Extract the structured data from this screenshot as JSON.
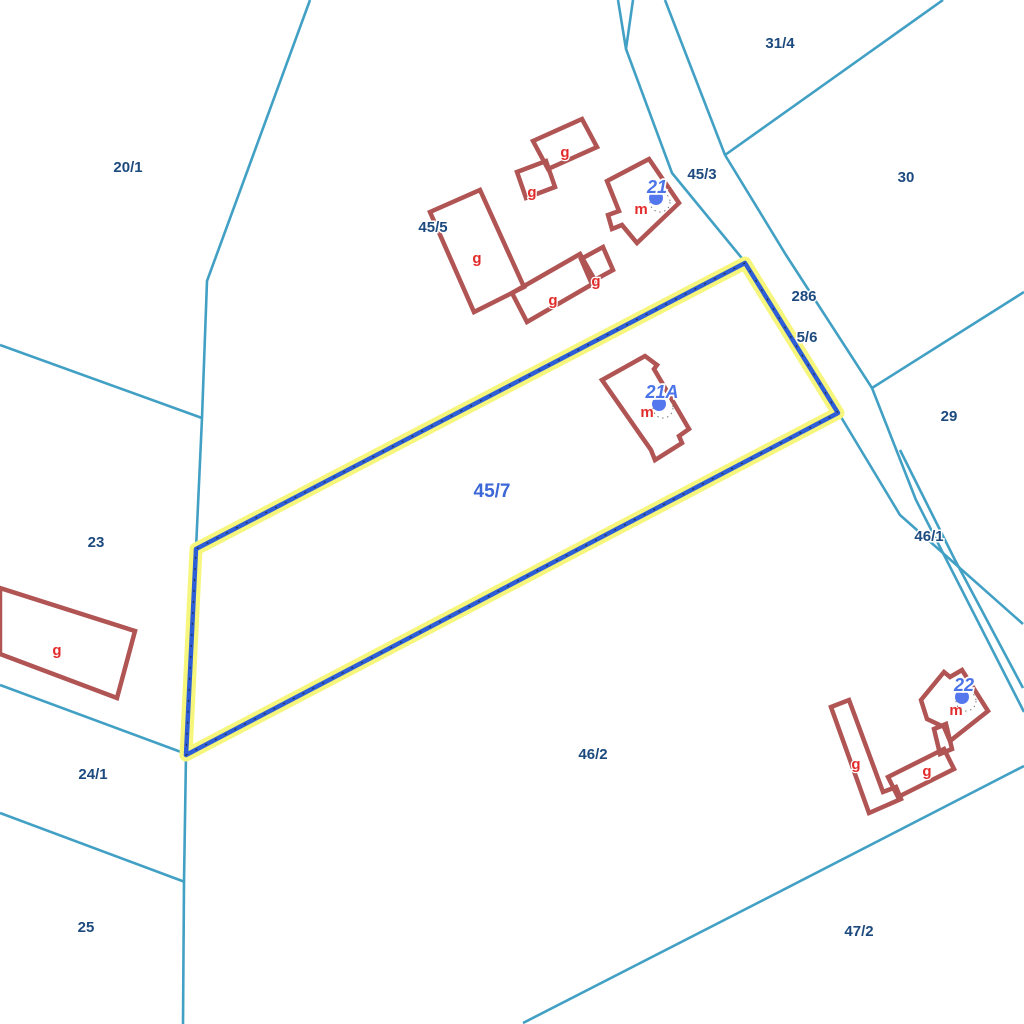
{
  "app": {
    "title": "cadastral-parcel-map"
  },
  "colors": {
    "background": "#ffffff",
    "boundary_teal": "#41a0c4",
    "parcel_label_navy": "#1d4a7e",
    "selected_parcel_blue": "#3c67d6",
    "highlight_halo_yellow": "#f6f67d",
    "highlight_core_blue": "#2d5dd7",
    "highlight_tick_dark": "#222222",
    "building_outline_red": "#b05454",
    "building_label_red": "#e22b2b",
    "address_number_blue": "#4b74e8",
    "address_dot_blue": "#5577ee",
    "label_halo_white": "#ffffff"
  },
  "map": {
    "width": 1024,
    "height": 1024,
    "selected_parcel": {
      "id": "45/7"
    },
    "highlight": {
      "name": "selected-parcel-45-7",
      "points": [
        [
          745,
          263
        ],
        [
          196,
          549
        ],
        [
          186,
          755
        ],
        [
          838,
          413
        ]
      ]
    },
    "boundaries": [
      {
        "name": "boundary-west-long",
        "points": [
          [
            310,
            0
          ],
          [
            207,
            281
          ],
          [
            202,
            418
          ],
          [
            196,
            549
          ],
          [
            186,
            755
          ],
          [
            184,
            882
          ],
          [
            183,
            1024
          ]
        ]
      },
      {
        "name": "boundary-20-1-23",
        "points": [
          [
            0,
            345
          ],
          [
            202,
            418
          ]
        ]
      },
      {
        "name": "boundary-23-24-1",
        "points": [
          [
            0,
            685
          ],
          [
            181,
            752
          ]
        ]
      },
      {
        "name": "boundary-24-1-25",
        "points": [
          [
            0,
            813
          ],
          [
            185,
            882
          ]
        ]
      },
      {
        "name": "road-west-edge-upper",
        "points": [
          [
            618,
            0
          ],
          [
            626,
            49
          ],
          [
            672,
            173
          ],
          [
            745,
            262
          ]
        ]
      },
      {
        "name": "road-fork-top",
        "points": [
          [
            633,
            0
          ],
          [
            626,
            49
          ]
        ]
      },
      {
        "name": "road-east-edge-top",
        "points": [
          [
            665,
            0
          ],
          [
            725,
            155
          ]
        ]
      },
      {
        "name": "boundary-31-4-30",
        "points": [
          [
            725,
            155
          ],
          [
            943,
            0
          ]
        ]
      },
      {
        "name": "road-east-edge-mid",
        "points": [
          [
            725,
            155
          ],
          [
            786,
            255
          ],
          [
            872,
            388
          ]
        ]
      },
      {
        "name": "boundary-30-29",
        "points": [
          [
            872,
            388
          ],
          [
            1024,
            292
          ]
        ]
      },
      {
        "name": "road-west-edge-lower",
        "points": [
          [
            838,
            412
          ],
          [
            900,
            515
          ],
          [
            1023,
            624
          ]
        ]
      },
      {
        "name": "road-east-edge-lower",
        "points": [
          [
            872,
            388
          ],
          [
            916,
            500
          ],
          [
            1024,
            712
          ]
        ]
      },
      {
        "name": "road-strip-46-1",
        "points": [
          [
            900,
            450
          ],
          [
            955,
            560
          ],
          [
            1023,
            688
          ]
        ]
      },
      {
        "name": "boundary-46-2-47-2",
        "points": [
          [
            523,
            1023
          ],
          [
            779,
            892
          ],
          [
            1024,
            766
          ]
        ]
      }
    ],
    "parcel_labels": [
      {
        "text": "20/1",
        "x": 128,
        "y": 172
      },
      {
        "text": "31/4",
        "x": 780,
        "y": 48
      },
      {
        "text": "30",
        "x": 906,
        "y": 182
      },
      {
        "text": "45/3",
        "x": 702,
        "y": 179
      },
      {
        "text": "45/5",
        "x": 433,
        "y": 232
      },
      {
        "text": "286",
        "x": 804,
        "y": 301
      },
      {
        "text": "5/6",
        "x": 807,
        "y": 342
      },
      {
        "text": "29",
        "x": 949,
        "y": 421
      },
      {
        "text": "46/1",
        "x": 929,
        "y": 541
      },
      {
        "text": "23",
        "x": 96,
        "y": 547
      },
      {
        "text": "24/1",
        "x": 93,
        "y": 779
      },
      {
        "text": "25",
        "x": 86,
        "y": 932
      },
      {
        "text": "46/2",
        "x": 593,
        "y": 759
      },
      {
        "text": "47/2",
        "x": 859,
        "y": 936
      }
    ],
    "selected_parcel_label": {
      "text": "45/7",
      "x": 492,
      "y": 497
    },
    "buildings": [
      {
        "name": "building-outbuilding-top",
        "points": [
          [
            533,
            141
          ],
          [
            582,
            119
          ],
          [
            597,
            147
          ],
          [
            548,
            169
          ]
        ]
      },
      {
        "name": "building-shed-small-top",
        "points": [
          [
            517,
            172
          ],
          [
            546,
            161
          ],
          [
            555,
            187
          ],
          [
            526,
            198
          ]
        ]
      },
      {
        "name": "building-barn-45-5",
        "points": [
          [
            430,
            212
          ],
          [
            480,
            190
          ],
          [
            524,
            287
          ],
          [
            474,
            312
          ]
        ]
      },
      {
        "name": "building-long-shed-45-5",
        "points": [
          [
            512,
            293
          ],
          [
            580,
            254
          ],
          [
            596,
            282
          ],
          [
            527,
            322
          ]
        ]
      },
      {
        "name": "building-shed-small-right",
        "points": [
          [
            581,
            259
          ],
          [
            603,
            247
          ],
          [
            613,
            270
          ],
          [
            591,
            282
          ]
        ]
      },
      {
        "name": "building-house-21",
        "points": [
          [
            649,
            159
          ],
          [
            679,
            203
          ],
          [
            637,
            243
          ],
          [
            622,
            225
          ],
          [
            612,
            229
          ],
          [
            608,
            215
          ],
          [
            619,
            211
          ],
          [
            607,
            181
          ]
        ]
      },
      {
        "name": "building-house-21a",
        "points": [
          [
            645,
            356
          ],
          [
            657,
            365
          ],
          [
            654,
            369
          ],
          [
            689,
            429
          ],
          [
            679,
            436
          ],
          [
            682,
            443
          ],
          [
            655,
            460
          ],
          [
            651,
            450
          ],
          [
            602,
            380
          ]
        ]
      },
      {
        "name": "building-shed-left-edge",
        "points": [
          [
            0,
            588
          ],
          [
            135,
            631
          ],
          [
            117,
            698
          ],
          [
            0,
            654
          ]
        ]
      },
      {
        "name": "building-tall-shed-22",
        "points": [
          [
            831,
            707
          ],
          [
            849,
            700
          ],
          [
            883,
            792
          ],
          [
            896,
            787
          ],
          [
            901,
            799
          ],
          [
            869,
            813
          ]
        ]
      },
      {
        "name": "building-low-shed-22",
        "points": [
          [
            888,
            777
          ],
          [
            944,
            749
          ],
          [
            954,
            769
          ],
          [
            898,
            797
          ]
        ]
      },
      {
        "name": "building-connector-22",
        "points": [
          [
            934,
            729
          ],
          [
            946,
            724
          ],
          [
            952,
            749
          ],
          [
            940,
            754
          ]
        ]
      },
      {
        "name": "building-house-22",
        "points": [
          [
            921,
            700
          ],
          [
            944,
            672
          ],
          [
            950,
            677
          ],
          [
            962,
            670
          ],
          [
            988,
            711
          ],
          [
            950,
            741
          ],
          [
            944,
            727
          ],
          [
            927,
            719
          ]
        ]
      }
    ],
    "use_labels": [
      {
        "text": "g",
        "x": 565,
        "y": 157
      },
      {
        "text": "g",
        "x": 532,
        "y": 197
      },
      {
        "text": "g",
        "x": 477,
        "y": 263
      },
      {
        "text": "g",
        "x": 553,
        "y": 305
      },
      {
        "text": "g",
        "x": 596,
        "y": 286
      },
      {
        "text": "g",
        "x": 57,
        "y": 655
      },
      {
        "text": "g",
        "x": 856,
        "y": 769
      },
      {
        "text": "g",
        "x": 927,
        "y": 776
      },
      {
        "text": "m",
        "x": 641,
        "y": 214
      },
      {
        "text": "m",
        "x": 647,
        "y": 417
      },
      {
        "text": "m",
        "x": 956,
        "y": 715
      }
    ],
    "address_points": [
      {
        "number": "21",
        "x": 657,
        "y": 193,
        "dot": [
          656,
          198
        ]
      },
      {
        "number": "21A",
        "x": 662,
        "y": 398,
        "dot": [
          659,
          404
        ]
      },
      {
        "number": "22",
        "x": 964,
        "y": 691,
        "dot": [
          962,
          697
        ]
      }
    ]
  }
}
